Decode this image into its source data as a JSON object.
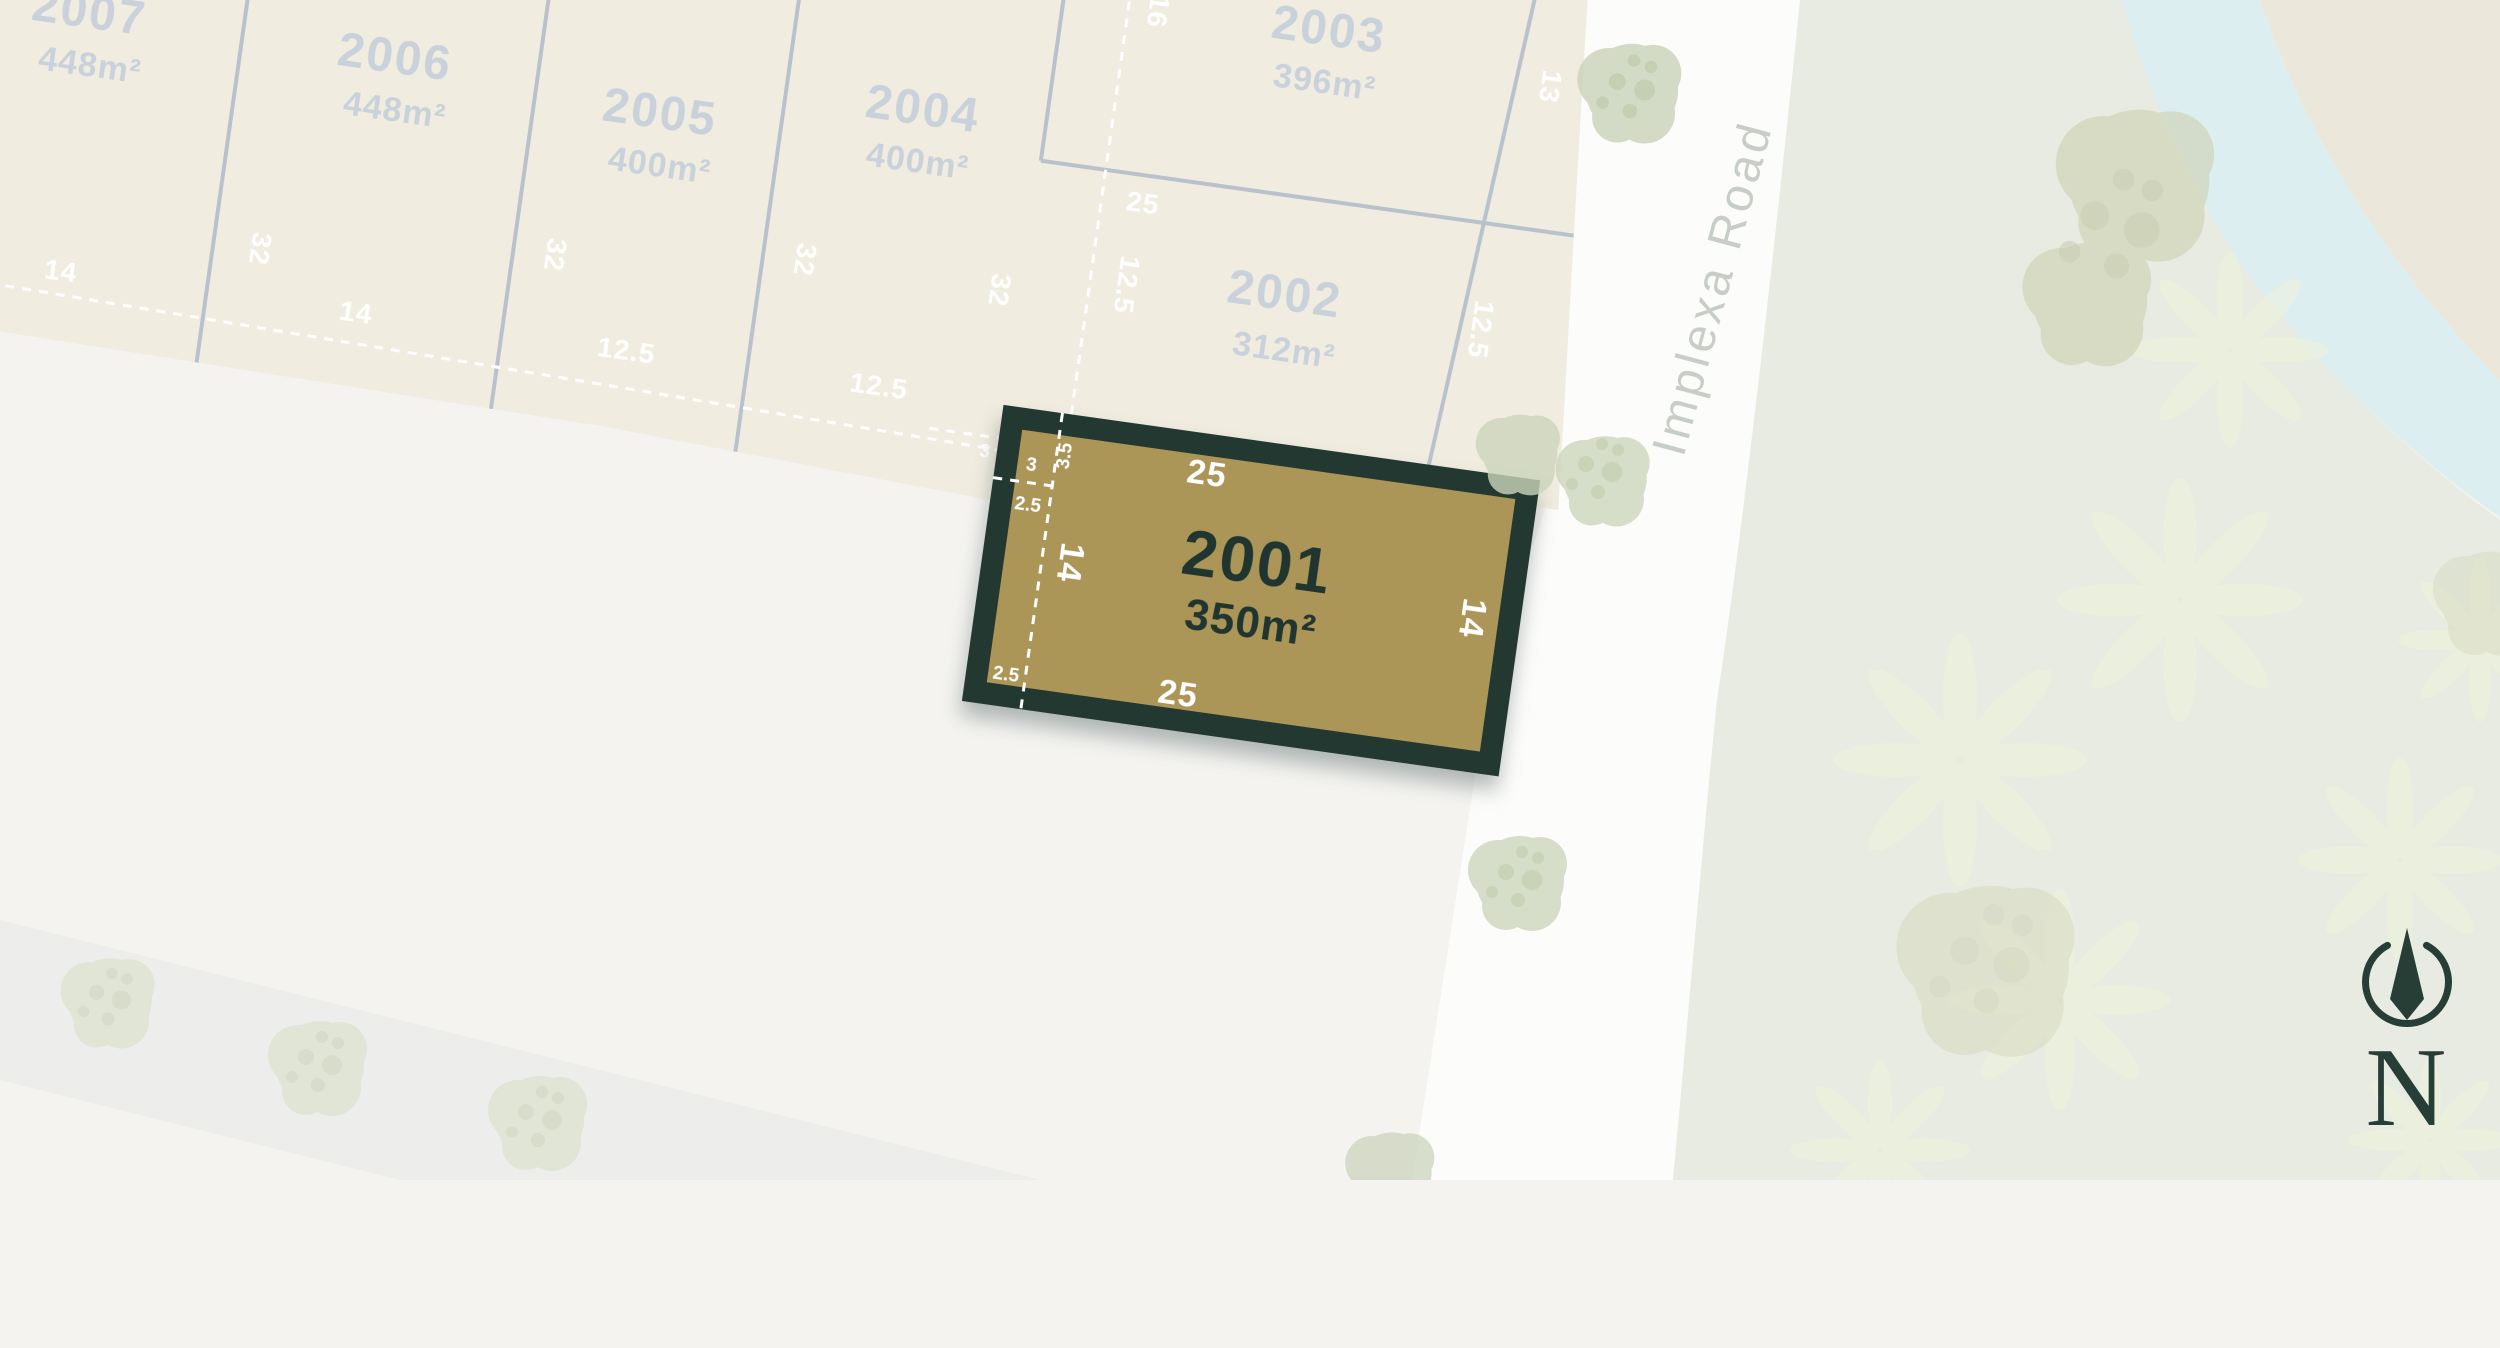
{
  "map": {
    "road": {
      "name": "Implexa Road"
    },
    "compass": {
      "label": "N"
    },
    "lots": [
      {
        "id": "2007",
        "area": "448m²"
      },
      {
        "id": "2006",
        "area": "448m²"
      },
      {
        "id": "2005",
        "area": "400m²"
      },
      {
        "id": "2004",
        "area": "400m²"
      },
      {
        "id": "2003",
        "area": "396m²"
      },
      {
        "id": "2002",
        "area": "312m²"
      },
      {
        "id": "2001",
        "area": "350m²",
        "highlighted": true
      }
    ],
    "dimensions": {
      "frontages_row": [
        "14",
        "14",
        "12.5",
        "12.5"
      ],
      "depths_row": [
        "32",
        "32",
        "32",
        "32"
      ],
      "lot2003_rear": "16",
      "lot2003_frontage": "13",
      "lot2002_top": "25",
      "lot2002_rear": "12.5",
      "lot2002_frontage": "12.5",
      "lot2001": {
        "top": "25",
        "bottom": "25",
        "left": "14",
        "right": "14",
        "easement_height": "3.5",
        "easement_width": "3",
        "easement_offset_top": "2.5",
        "easement_offset_bottom": "2.5",
        "outside_offset": "3"
      }
    },
    "colors": {
      "highlight_fill": "#ab9557",
      "highlight_border": "#233831",
      "lot_fill": "#f0ecdf",
      "lot_text": "#c9d1db",
      "boundary_line": "#b8c2cd",
      "river": "#dceef0",
      "park": "#e7ebe1",
      "road_label": "#c7cdc7",
      "dark_text": "#203530"
    }
  }
}
